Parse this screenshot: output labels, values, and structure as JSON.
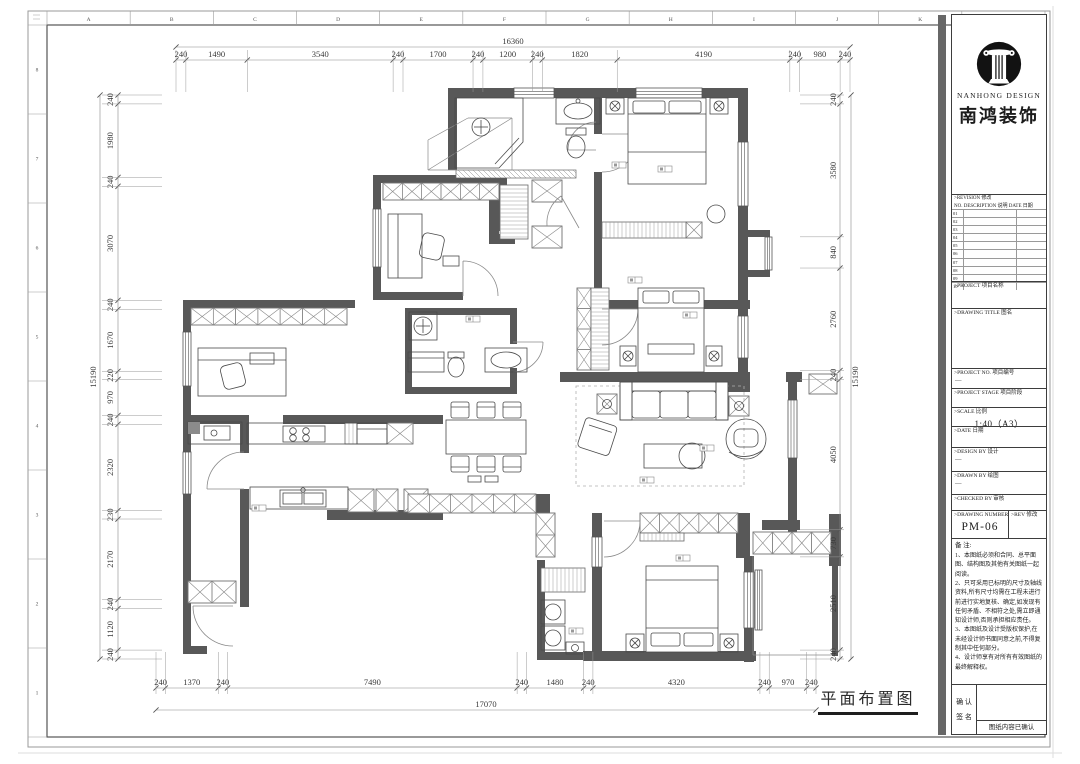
{
  "frame": {
    "grid_letters_top": [
      "A",
      "B",
      "C",
      "D",
      "E",
      "F",
      "G",
      "H",
      "I",
      "J",
      "K"
    ],
    "grid_numbers_left": [
      "8",
      "7",
      "6",
      "5",
      "4",
      "3",
      "2",
      "1"
    ]
  },
  "plan": {
    "title": "平面布置图",
    "dims": {
      "top": {
        "overall": "16360",
        "segments": [
          "240",
          "1490",
          "3540",
          "240",
          "1700",
          "240",
          "1200",
          "240",
          "1820",
          "4190",
          "240",
          "980",
          "240"
        ]
      },
      "bottom": {
        "overall": "17070",
        "segments": [
          "240",
          "1370",
          "240",
          "7490",
          "240",
          "1480",
          "240",
          "4320",
          "240",
          "970",
          "240"
        ]
      },
      "left": {
        "overall": "15190",
        "segments": [
          "240",
          "1980",
          "240",
          "3070",
          "240",
          "1670",
          "220",
          "970",
          "240",
          "2320",
          "230",
          "2170",
          "240",
          "1120",
          "240"
        ]
      },
      "right": {
        "overall": "15190",
        "segments": [
          "240",
          "3580",
          "840",
          "2760",
          "240",
          "4050",
          "730",
          "2510",
          "240"
        ]
      }
    }
  },
  "titleblock": {
    "logo_en": "NANHONG DESIGN",
    "logo_cn": "南鸿装饰",
    "revision": {
      "head1": ">REVISION  修改",
      "head2": "NO.  DESCRIPTION 说明   DATE 日期",
      "rows": [
        "01",
        "02",
        "03",
        "04",
        "05",
        "06",
        "07",
        "08",
        "09",
        "10"
      ]
    },
    "fields": [
      {
        "label": ">PROJECT  项目名称",
        "value": ""
      },
      {
        "label": ">DRAWING TITLE  图名",
        "value": ""
      },
      {
        "label": ">PROJECT NO.  项目编号",
        "value": "—"
      },
      {
        "label": ">PROJECT STAGE  项目阶段",
        "value": ""
      },
      {
        "label": ">SCALE  比例",
        "value": "—",
        "scale_value": "1:40（A3）"
      },
      {
        "label": ">DATE  日期",
        "value": ""
      },
      {
        "label": ">DESIGN BY  设计",
        "value": "—"
      },
      {
        "label": ">DRAWN BY  绘图",
        "value": "—"
      },
      {
        "label": ">CHECKED BY  审核",
        "value": ""
      }
    ],
    "drawing_number": {
      "label": ">DRAWING NUMBER  图号",
      "value": "PM-06",
      "rev_label": ">REV  修改"
    },
    "notes_title": "备 注:",
    "notes": [
      "1、本图纸必须和合同、总平面图、结构图及其他有关图纸一起阅读。",
      "2、只可采用已标明的尺寸及轴线资料,所有尺寸均需在工程未进行前进行实地复核、确定,如发现有任何矛盾、不相符之处,需立即通知设计师,否则承担相应责任。",
      "3、本图纸及设计受版权保护,在未经设计师书面同意之前,不得复制其中任何部分。",
      "4、设计师享有对所有有效图纸的最终解释权。"
    ],
    "confirm": {
      "label1": "确 认",
      "label2": "签 名",
      "note": "图纸内容已确认"
    }
  }
}
